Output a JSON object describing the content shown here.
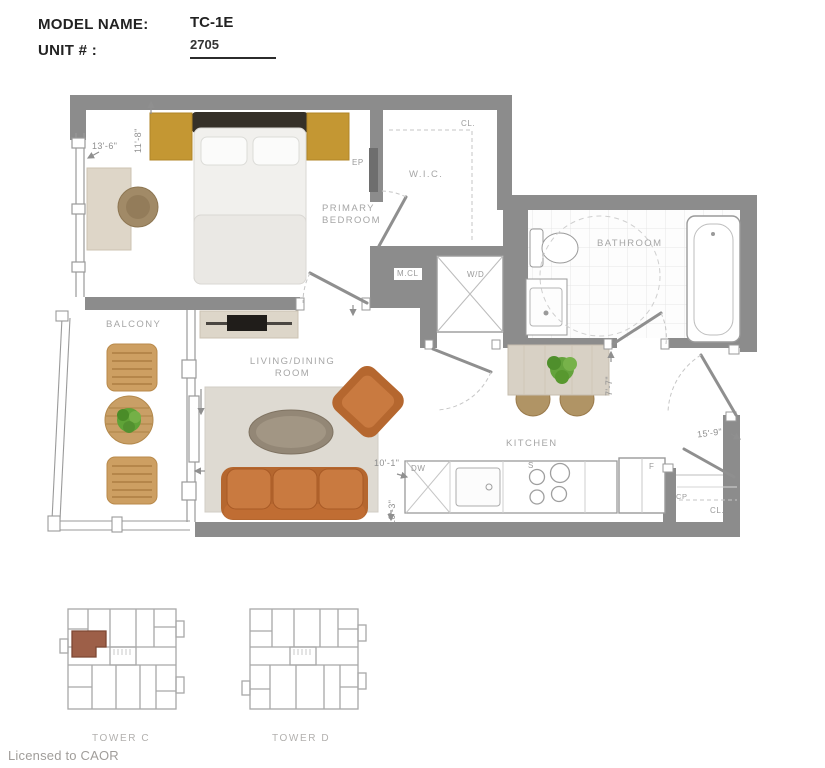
{
  "header": {
    "model_name_label": "MODEL NAME:",
    "unit_label": "UNIT # :",
    "model_name": "TC-1E",
    "unit_number": "2705"
  },
  "plan": {
    "bedroom": {
      "label_line1": "PRIMARY",
      "label_line2": "BEDROOM",
      "ep": "EP",
      "width": "13'-6\"",
      "depth": "11'-8\""
    },
    "wic": {
      "label": "W.I.C.",
      "cl": "CL."
    },
    "mcl": "M.CL",
    "wd": "W/D",
    "bathroom": {
      "label": "BATHROOM"
    },
    "balcony": {
      "label": "BALCONY"
    },
    "living": {
      "label_line1": "LIVING/DINING",
      "label_line2": "ROOM",
      "width": "10'-1\"",
      "depth": "10'-3\""
    },
    "kitchen": {
      "label": "KITCHEN",
      "dw": "DW",
      "stove": "S",
      "fridge": "F",
      "depth": "7'-7\""
    },
    "entry": {
      "width": "15'-9\"",
      "cp": "CP",
      "cl": "CL."
    }
  },
  "keyplans": {
    "tower_c": "TOWER C",
    "tower_d": "TOWER D"
  },
  "footer": {
    "license": "Licensed to CAOR"
  },
  "colors": {
    "wall": "#8c8c8c",
    "nightstand": "#c49733",
    "sofa": "#c97a40",
    "highlight_unit": "#9d5f48",
    "label": "#a6a6a6"
  }
}
